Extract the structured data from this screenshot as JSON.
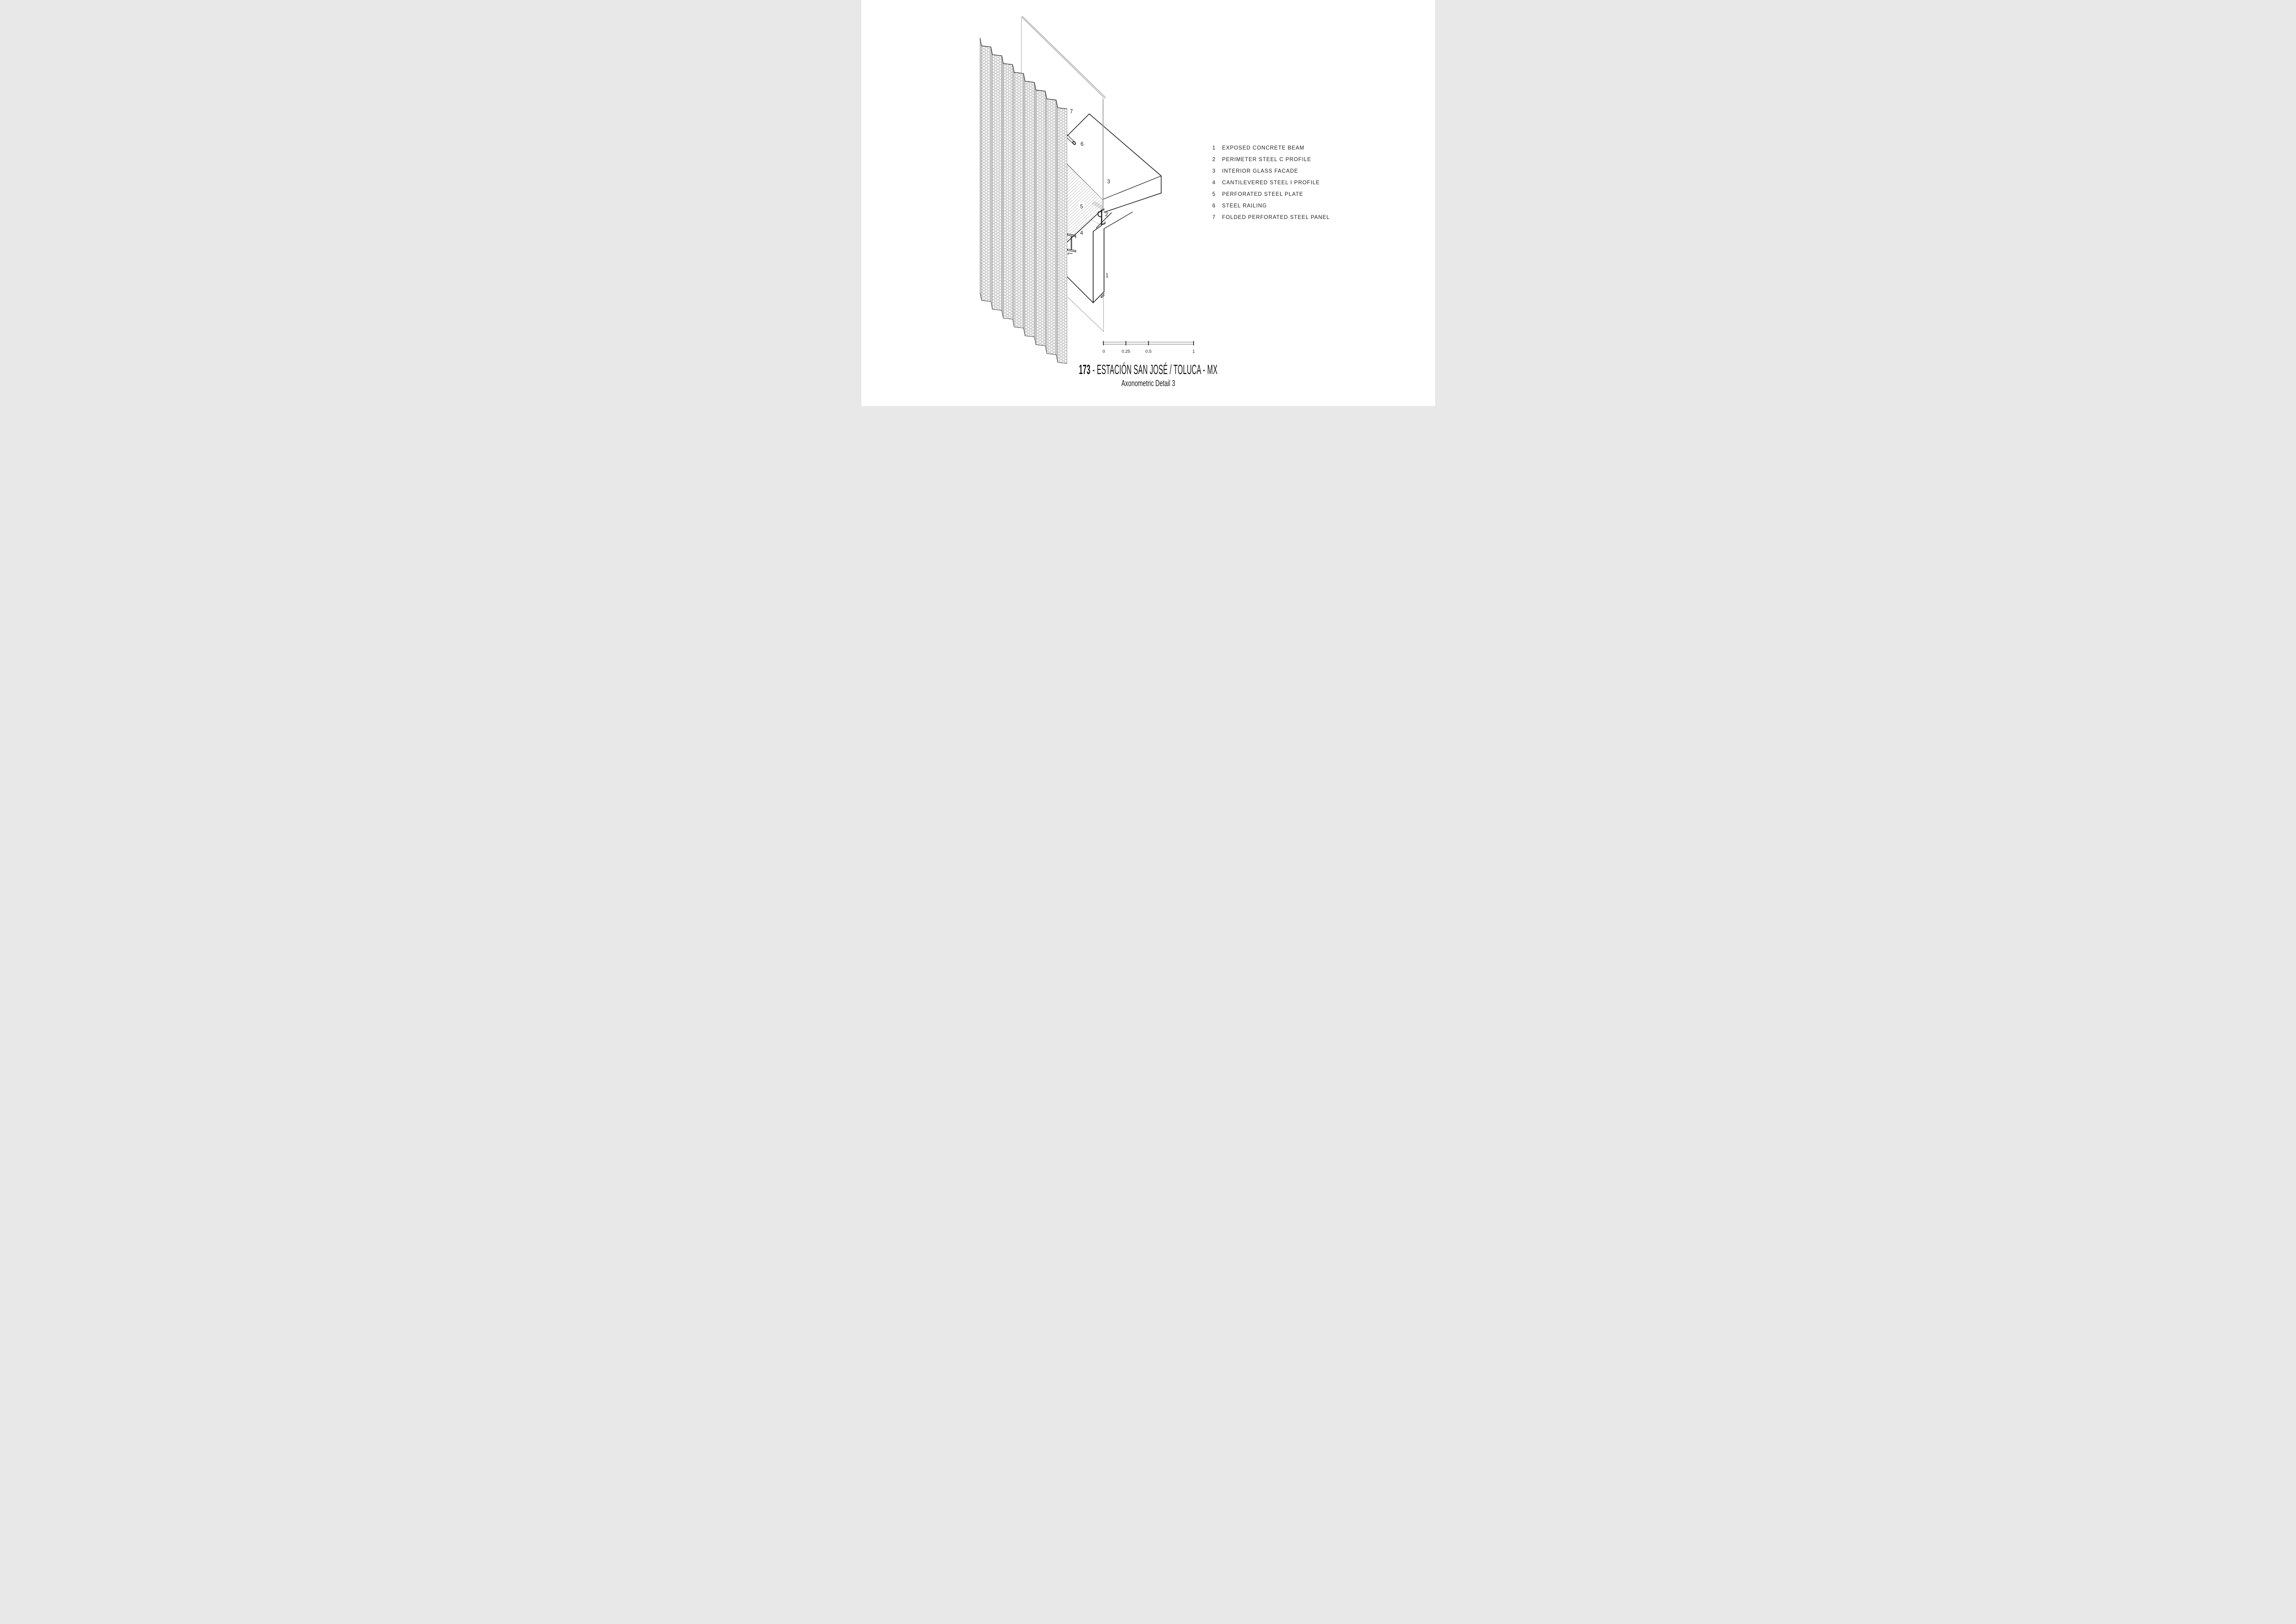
{
  "title": {
    "number": "173",
    "rest": "- ESTACIÓN SAN JOSÉ / TOLUCA - MX",
    "subtitle": "Axonometric Detail 3"
  },
  "legend": {
    "items": [
      {
        "num": "1",
        "label": "EXPOSED CONCRETE BEAM"
      },
      {
        "num": "2",
        "label": "PERIMETER STEEL C PROFILE"
      },
      {
        "num": "3",
        "label": "INTERIOR GLASS FACADE"
      },
      {
        "num": "4",
        "label": "CANTILEVERED STEEL I PROFILE"
      },
      {
        "num": "5",
        "label": "PERFORATED STEEL PLATE"
      },
      {
        "num": "6",
        "label": "STEEL RAILING"
      },
      {
        "num": "7",
        "label": "FOLDED PERFORATED STEEL PANEL"
      }
    ]
  },
  "scale_bar": {
    "labels": [
      "0",
      "0.25",
      "0.5",
      "1"
    ]
  },
  "colors": {
    "ink": "#1c1c1c",
    "thin_line": "#9a9a9a",
    "background": "#ffffff"
  }
}
